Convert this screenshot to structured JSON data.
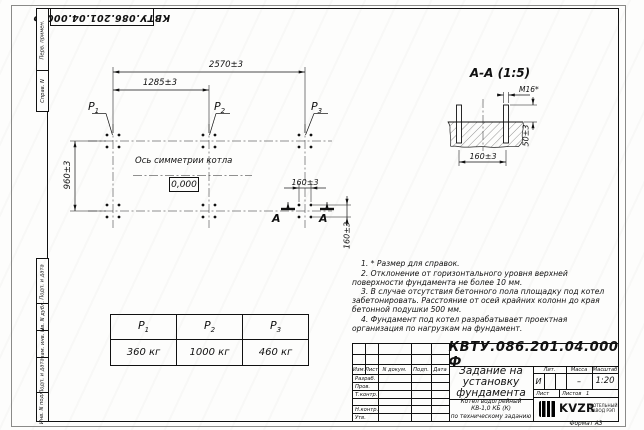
{
  "sheet": {
    "corner_stamp": "КВТУ.086.201.04.000 Ф",
    "format_label": "Формат А3",
    "margin_labels": [
      "Перв. примен.",
      "Справ. N",
      "Подп. и дата",
      "Инв. N дубл.",
      "Взам. инв. N",
      "Подп. и дата",
      "Инв. N подл."
    ]
  },
  "plan": {
    "dim_overall": "2570±3",
    "dim_half": "1285±3",
    "dim_depth": "960±3",
    "dim_bolt_x": "160±3",
    "dim_bolt_y": "160±3",
    "axis_label": "Ось симметрии котла",
    "elevation": "0,000",
    "section_letter_left": "А",
    "section_letter_right": "А",
    "p_marks": [
      {
        "base": "P",
        "sub": "1"
      },
      {
        "base": "P",
        "sub": "2"
      },
      {
        "base": "P",
        "sub": "3"
      }
    ]
  },
  "section": {
    "title": "А-А (1:5)",
    "thread_label": "М16*",
    "dim_height": "50±3",
    "dim_spacing": "160±3"
  },
  "notes": [
    "1. * Размер для справок.",
    "2. Отклонение от горизонтального уровня верхней поверхности фундамента не более 10 мм.",
    "3. В случае отсутствия бетонного пола площадку под котел забетонировать. Расстояние от осей крайних колонн до края бетонной подушки 500 мм.",
    "4. Фундамент под котел разрабатывает проектная организация по нагрузкам на фундамент."
  ],
  "load_table": {
    "headers": [
      {
        "base": "P",
        "sub": "1"
      },
      {
        "base": "P",
        "sub": "2"
      },
      {
        "base": "P",
        "sub": "3"
      }
    ],
    "values": [
      "360 кг",
      "1000 кг",
      "460 кг"
    ]
  },
  "title_block": {
    "doc_number": "КВТУ.086.201.04.000 Ф",
    "title": "Задание на\nустановку\nфундамента",
    "object": "Котел водогрейный\nКВ-1,0 КБ (К)\nпо техническому заданию",
    "header_cols": [
      "Изм.",
      "Лист",
      "N докум.",
      "Подп.",
      "Дата"
    ],
    "sig_rows": [
      "Разраб.",
      "Пров.",
      "Т.контр.",
      "Н.контр.",
      "Утв."
    ],
    "lit_header": [
      "Лит.",
      "Масса",
      "Масштаб"
    ],
    "lit_value": "И",
    "mass_value": "–",
    "scale_value": "1:20",
    "sheet_label": "Лист",
    "sheets_label": "Листов",
    "sheets_value": "1",
    "company": {
      "logo_text": "KVZR",
      "tagline": "КОТЕЛЬНЫЙ\nЗАВОД РЭП"
    }
  },
  "colors": {
    "line": "#111111",
    "paper": "#fdfdfc"
  }
}
